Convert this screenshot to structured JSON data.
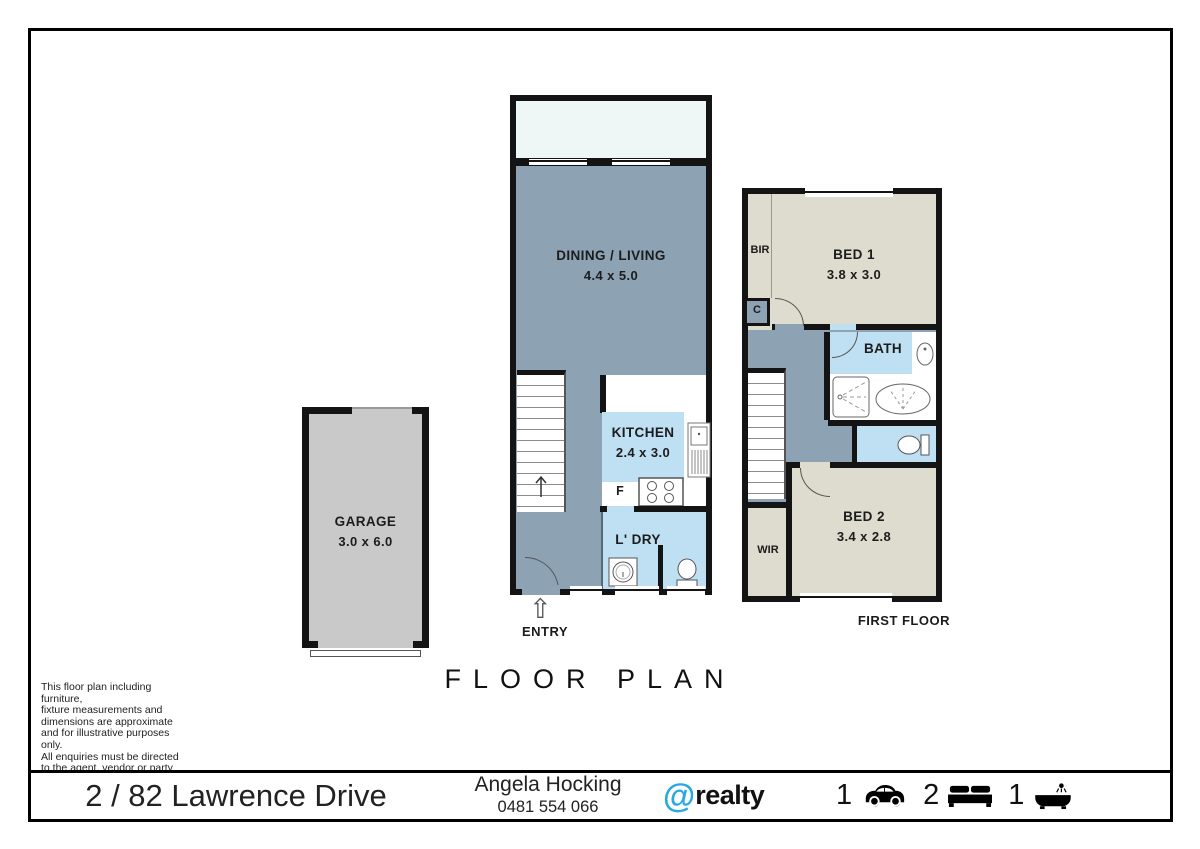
{
  "page": {
    "title": "FLOOR PLAN"
  },
  "ground_floor": {
    "entry_label": "ENTRY",
    "entry_arrow_glyph": "⇧",
    "dining_living": {
      "name": "DINING / LIVING",
      "dims": "4.4 x 5.0"
    },
    "kitchen": {
      "name": "KITCHEN",
      "dims": "2.4 x 3.0",
      "fridge_label": "F"
    },
    "laundry": {
      "name": "L' DRY"
    }
  },
  "garage": {
    "name": "GARAGE",
    "dims": "3.0 x 6.0"
  },
  "first_floor": {
    "label": "FIRST FLOOR",
    "bed1": {
      "name": "BED 1",
      "dims": "3.8 x 3.0"
    },
    "bed2": {
      "name": "BED 2",
      "dims": "3.4 x 2.8"
    },
    "bath": {
      "name": "BATH"
    },
    "bir_label": "BIR",
    "cupboard_label": "C",
    "wir_label": "WIR"
  },
  "disclaimer": {
    "text": "This floor plan including furniture,\nfixture measurements and\ndimensions are approximate\nand for illustrative purposes only.\nAll enquiries must be directed\nto the agent, vendor or party\nrepresenting this floor plan."
  },
  "footer": {
    "address": "2 / 82 Lawrence Drive",
    "agent_name": "Angela Hocking",
    "agent_phone": "0481 554 066",
    "brand": {
      "at": "@",
      "name": "realty"
    },
    "stats": [
      {
        "count": "1",
        "icon": "car-icon"
      },
      {
        "count": "2",
        "icon": "bed-icon"
      },
      {
        "count": "1",
        "icon": "bath-icon"
      }
    ]
  },
  "colors": {
    "hallway": "#8da3b4",
    "wet_area": "#bfe0f2",
    "bedroom": "#dddcce",
    "garage": "#c9c9c9",
    "balcony": "#eef6f6",
    "wall": "#141414",
    "brand_blue": "#2aa9e0"
  }
}
